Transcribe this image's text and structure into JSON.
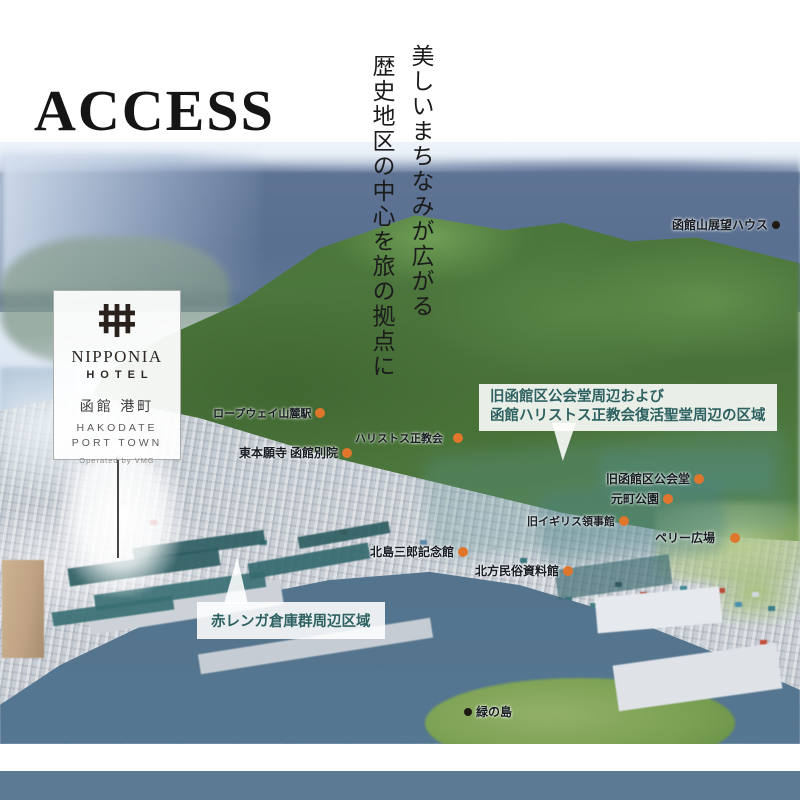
{
  "page": {
    "title": "ACCESS",
    "tagline_line1": "美しいまちなみが広がる",
    "tagline_line2": "歴史地区の中心を旅の拠点に"
  },
  "hotel_card": {
    "logo_icon": "nipponia-lattice-icon",
    "brand": "NIPPONIA",
    "brand_sub": "HOTEL",
    "name_jp": "函館 港町",
    "name_en_line1": "HAKODATE",
    "name_en_line2": "PORT TOWN",
    "operated_by": "Operated by VMG"
  },
  "map": {
    "area_labels": [
      {
        "line1": "旧函館区公会堂周辺および",
        "line2": "函館ハリストス正教会復活聖堂周辺の区域"
      },
      {
        "text": "赤レンガ倉庫群周辺区域"
      }
    ],
    "poi_labels": [
      {
        "text": "函館山展望ハウス",
        "marker": "black"
      },
      {
        "text": "ロープウェイ山麓駅",
        "marker": "orange"
      },
      {
        "text": "ハリストス正教会",
        "marker": "orange"
      },
      {
        "text": "東本願寺 函館別院",
        "marker": "orange"
      },
      {
        "text": "旧函館区公会堂",
        "marker": "orange"
      },
      {
        "text": "元町公園",
        "marker": "orange"
      },
      {
        "text": "旧イギリス領事館",
        "marker": "orange"
      },
      {
        "text": "ペリー広場",
        "marker": "orange"
      },
      {
        "text": "北島三郎記念館",
        "marker": "orange"
      },
      {
        "text": "北方民俗資料館",
        "marker": "orange"
      },
      {
        "text": "緑の島",
        "marker": "black"
      }
    ],
    "colors": {
      "marker_orange": "#e0762c",
      "marker_black": "#1d1812",
      "area_label_text": "#2e6161",
      "footer_bar": "#5b7a94"
    }
  }
}
